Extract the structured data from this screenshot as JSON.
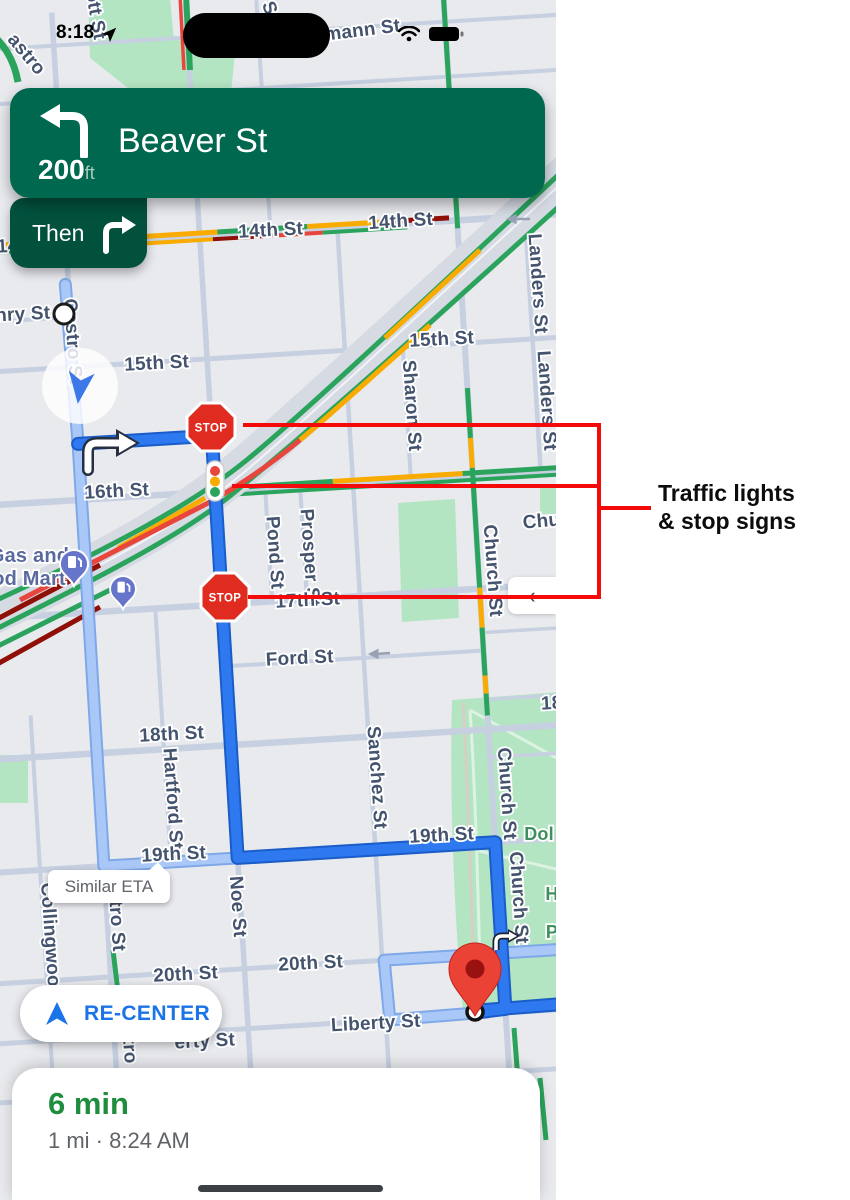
{
  "status_bar": {
    "time": "8:18"
  },
  "nav_banner": {
    "distance": "200",
    "distance_unit": "ft",
    "instruction": "Beaver St"
  },
  "then_chip": {
    "label": "Then"
  },
  "map": {
    "stop_sign_label": "STOP",
    "similar_eta_label": "Similar ETA",
    "labels": [
      {
        "t": "mann St",
        "x": 363,
        "y": 36,
        "r": -7
      },
      {
        "t": "ott St",
        "x": 90,
        "y": 16,
        "r": 80
      },
      {
        "t": "S",
        "x": 264,
        "y": 10,
        "r": 70
      },
      {
        "t": "astro",
        "x": 22,
        "y": 58,
        "r": 50
      },
      {
        "t": "14",
        "x": 8,
        "y": 252,
        "r": -3
      },
      {
        "t": "14th St",
        "x": 271,
        "y": 236,
        "r": -3
      },
      {
        "t": "14th St",
        "x": 401,
        "y": 227,
        "r": -4
      },
      {
        "t": "Landers St",
        "x": 532,
        "y": 284,
        "r": 86
      },
      {
        "t": "Landers St",
        "x": 541,
        "y": 401,
        "r": 86
      },
      {
        "t": "nry St",
        "x": 23,
        "y": 320,
        "r": -3
      },
      {
        "t": "Castro St",
        "x": 67,
        "y": 342,
        "r": 86
      },
      {
        "t": "15th St",
        "x": 157,
        "y": 369,
        "r": -3
      },
      {
        "t": "15th St",
        "x": 442,
        "y": 345,
        "r": -3
      },
      {
        "t": "Sharon St",
        "x": 406,
        "y": 406,
        "r": 86
      },
      {
        "t": "16th St",
        "x": 117,
        "y": 497,
        "r": -3
      },
      {
        "t": "Pond St",
        "x": 269,
        "y": 553,
        "r": 86
      },
      {
        "t": "Prosper St",
        "x": 304,
        "y": 558,
        "r": 86
      },
      {
        "t": "Church St",
        "x": 487,
        "y": 571,
        "r": 86
      },
      {
        "t": "Chu",
        "x": 542,
        "y": 527,
        "r": -5
      },
      {
        "t": "Gas and",
        "x": 29,
        "y": 562,
        "r": 0,
        "c": "poi"
      },
      {
        "t": "od Mart",
        "x": 29,
        "y": 585,
        "r": 0,
        "c": "poi"
      },
      {
        "t": "17th St",
        "x": 308,
        "y": 606,
        "r": -3
      },
      {
        "t": "Ford St",
        "x": 300,
        "y": 664,
        "r": -3
      },
      {
        "t": "18",
        "x": 552,
        "y": 709,
        "r": -3
      },
      {
        "t": "18th St",
        "x": 172,
        "y": 740,
        "r": -3
      },
      {
        "t": "Hartford St",
        "x": 167,
        "y": 799,
        "r": 86
      },
      {
        "t": "Sanchez St",
        "x": 371,
        "y": 778,
        "r": 86
      },
      {
        "t": "Church St",
        "x": 501,
        "y": 794,
        "r": 86
      },
      {
        "t": "Dol",
        "x": 539,
        "y": 840,
        "r": 0,
        "c": "park"
      },
      {
        "t": "19th St",
        "x": 174,
        "y": 860,
        "r": -3
      },
      {
        "t": "19th St",
        "x": 442,
        "y": 841,
        "r": -3
      },
      {
        "t": "Collingwood",
        "x": 45,
        "y": 941,
        "r": 86
      },
      {
        "t": "stro St",
        "x": 111,
        "y": 921,
        "r": 86
      },
      {
        "t": "Noe St",
        "x": 232,
        "y": 907,
        "r": 86
      },
      {
        "t": "Church St",
        "x": 513,
        "y": 898,
        "r": 86
      },
      {
        "t": "H",
        "x": 552,
        "y": 900,
        "r": 0,
        "c": "park"
      },
      {
        "t": "P",
        "x": 552,
        "y": 938,
        "r": 0,
        "c": "park"
      },
      {
        "t": "20th St",
        "x": 186,
        "y": 980,
        "r": -3
      },
      {
        "t": "20th St",
        "x": 311,
        "y": 969,
        "r": -3
      },
      {
        "t": "Liberty St",
        "x": 376,
        "y": 1029,
        "r": -3
      },
      {
        "t": "erty St",
        "x": 205,
        "y": 1047,
        "r": -3
      },
      {
        "t": "tro",
        "x": 124,
        "y": 1051,
        "r": 86
      }
    ]
  },
  "side_tab": {
    "chevron": "‹"
  },
  "recenter_button": {
    "label": "RE-CENTER"
  },
  "eta_card": {
    "duration": "6 min",
    "details": "1 mi · 8:24 AM"
  },
  "annotation": {
    "line1": "Traffic lights",
    "line2": "& stop signs"
  },
  "colors": {
    "banner_green": "#00684F",
    "then_green": "#02513D",
    "route_blue": "#2E78F0",
    "alt_route_blue": "#A9C8F8",
    "eta_green": "#1E8E3E",
    "link_blue": "#1A73E8",
    "annotation_red": "#F40A0A",
    "traffic_green": "#2AA45C",
    "traffic_yellow": "#F9AB00",
    "traffic_red": "#E8453C",
    "traffic_dark_red": "#8F1007"
  }
}
